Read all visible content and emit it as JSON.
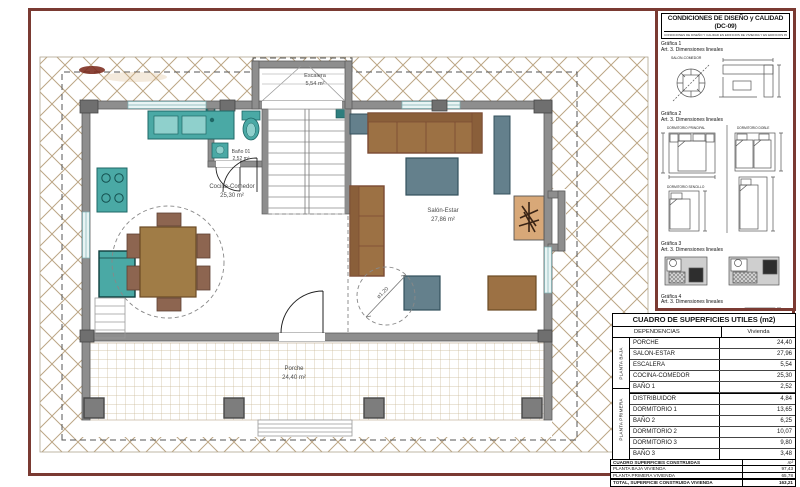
{
  "plan": {
    "rooms": {
      "escalera": {
        "name": "Escalera",
        "area": "5,54 m²"
      },
      "bano": {
        "name": "Baño 01",
        "area": "2,52 m²"
      },
      "cocina": {
        "name": "Cocina-Comedor",
        "area": "25,30 m²"
      },
      "salon": {
        "name": "Salón-Estar",
        "area": "27,86 m²"
      },
      "porche": {
        "name": "Porche",
        "area": "24,40 m²"
      }
    },
    "annotations": {
      "turning_circle": "ø1,20"
    }
  },
  "dc09": {
    "title": "CONDICIONES DE DISEÑO y CALIDAD (DC-09)",
    "subtitle": "CONDICIONES DE DISEÑO Y CALIDAD EN EDIFICIOS DE VIVIENDA Y EN EDIFICIOS PARA ALOJAMIENTO",
    "g1": {
      "title": "Gráfica 1",
      "art": "Art. 3. Dimensiones lineales",
      "caption": "SALON-COMEDOR"
    },
    "g2": {
      "title": "Gráfica 2",
      "art": "Art. 3. Dimensiones lineales",
      "cap_principal": "DORMITORIO PRINCIPAL",
      "cap_doble": "DORMITORIO DOBLE",
      "cap_sencillo": "DORMITORIO SENCILLO"
    },
    "g3": {
      "title": "Gráfica 3",
      "art": "Art. 3. Dimensiones lineales"
    },
    "g4": {
      "title": "Gráfica 4",
      "art": "Art. 3. Dimensiones lineales"
    }
  },
  "useful_table": {
    "title": "CUADRO DE SUPERFICIES UTILES (m2)",
    "col_dep": "DEPENDENCIAS",
    "col_viv": "Vivienda",
    "group1_label": "PLANTA BAJA",
    "group2_label": "PLANTA PRIMERA",
    "g1": [
      {
        "n": "PORCHE",
        "v": "24,40"
      },
      {
        "n": "SALON-ESTAR",
        "v": "27,96"
      },
      {
        "n": "ESCALERA",
        "v": "5,54"
      },
      {
        "n": "COCINA-COMEDOR",
        "v": "25,30"
      },
      {
        "n": "BAÑO 1",
        "v": "2,52"
      }
    ],
    "g2": [
      {
        "n": "DISTRIBUIDOR",
        "v": "4,84"
      },
      {
        "n": "DORMITORIO 1",
        "v": "13,65"
      },
      {
        "n": "BAÑO 2",
        "v": "6,25"
      },
      {
        "n": "DORMITORIO 2",
        "v": "10,07"
      },
      {
        "n": "DORMITORIO 3",
        "v": "9,80"
      },
      {
        "n": "BAÑO 3",
        "v": "3,48"
      }
    ],
    "total_label": "TOTAL, SUPERFICIE ÚTIL VIVIENDA",
    "total_value": "133,81"
  },
  "built_table": {
    "title": "CUADRO SUPERFICIES CONSTRUIDAS",
    "unit": "m²",
    "rows": [
      {
        "n": "PLANTA BAJA VIVIENDA",
        "v": "97,43"
      },
      {
        "n": "PLANTA PRIMERA VIVIENDA",
        "v": "65,78"
      }
    ],
    "total_label": "TOTAL, SUPERFICIE CONSTRUIDA VIVIENDA",
    "total_value": "163,21"
  },
  "colors": {
    "frame_maroon": "#7a3a32",
    "wall_gray": "#8e8e8e",
    "appliance_teal": "#4aa9a5",
    "furniture_brown": "#9c7144",
    "table_slate": "#64808c",
    "fireplace_tan": "#d8a878",
    "hatch_tan": "#bca685"
  }
}
